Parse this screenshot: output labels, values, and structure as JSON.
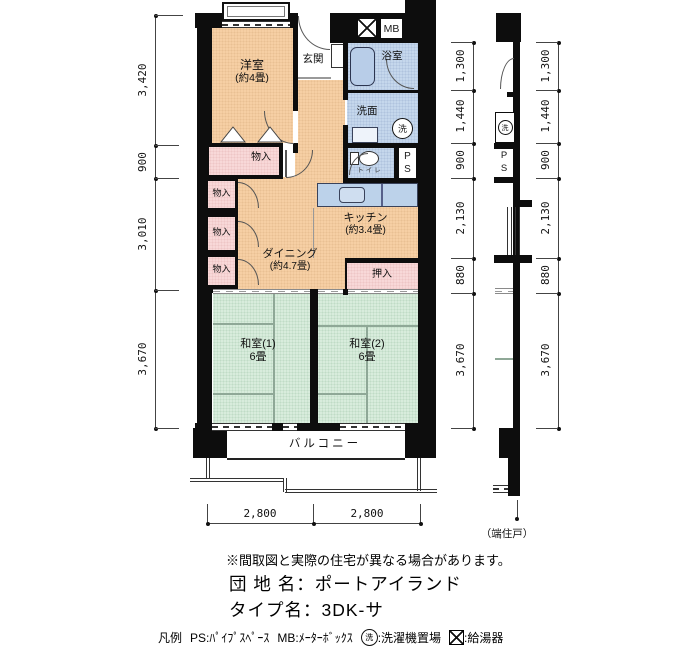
{
  "title_hint": "Japanese apartment floor plan (madori-zu)",
  "colors": {
    "room_orange": "#f6cfa4",
    "closet_pink": "#f8d8d8",
    "wet_area_blue": "#c5d7ec",
    "tatami_green": "#d8ecdc",
    "wall_black": "#0d0d0d"
  },
  "rooms": {
    "western": {
      "name": "洋室",
      "size": "(約4畳)"
    },
    "entrance": {
      "name": "玄関"
    },
    "bath": {
      "name": "浴室"
    },
    "washroom": {
      "name": "洗面"
    },
    "toilet": {
      "name": "トイレ"
    },
    "kitchen": {
      "name": "キッチン",
      "size": "(約3.4畳)"
    },
    "dining": {
      "name": "ダイニング",
      "size": "(約4.7畳)"
    },
    "japanese1": {
      "name": "和室(1)",
      "size": "6畳"
    },
    "japanese2": {
      "name": "和室(2)",
      "size": "6畳"
    },
    "closet": [
      "物入",
      "物入",
      "物入",
      "物入"
    ],
    "oshiire": "押入",
    "balcony": "バルコニー",
    "mb": "MB",
    "ps": [
      "P",
      "S"
    ],
    "washer_mark": "洗"
  },
  "dims": {
    "left": [
      "3,420",
      "900",
      "3,010",
      "3,670"
    ],
    "right_inner": [
      "1,300",
      "1,440",
      "900",
      "2,130",
      "880",
      "3,670"
    ],
    "right_outer": [
      "1,300",
      "1,440",
      "900",
      "2,130",
      "880",
      "3,670"
    ],
    "bottom": [
      "2,800",
      "2,800"
    ],
    "end_unit": "（端住戸）"
  },
  "footer": {
    "note": "※間取図と実際の住宅が異なる場合があります。",
    "estate": "団 地 名：ポートアイランド",
    "type": "タイプ名：3DK-サ",
    "legend_prefix": "凡例",
    "legend_ps": "PS:ﾊﾟｲﾌﾟｽﾍﾟｰｽ",
    "legend_mb": "MB:ﾒｰﾀｰﾎﾞｯｸｽ",
    "legend_washer": "洗",
    "legend_washer_text": ":洗濯機置場",
    "legend_heater_text": ":給湯器"
  }
}
